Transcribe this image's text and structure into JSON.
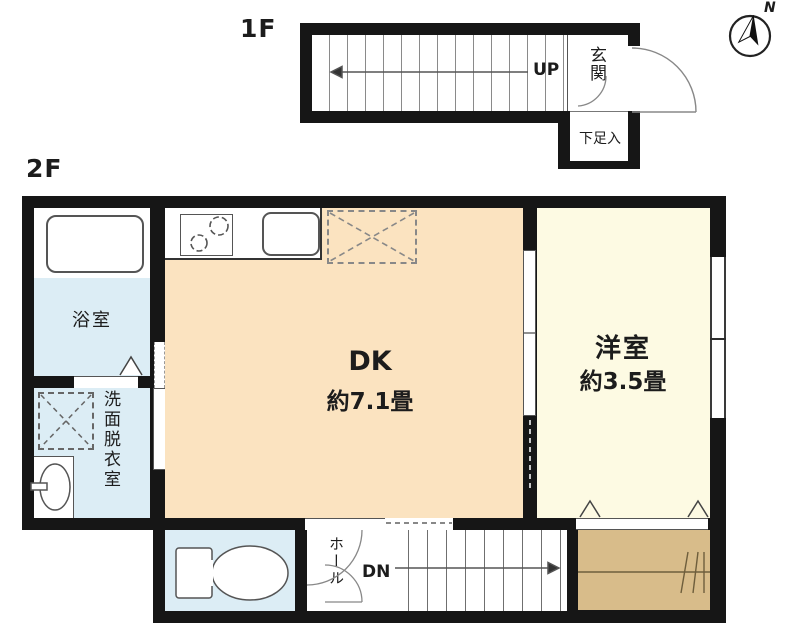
{
  "title": "間取り図",
  "compass": {
    "label": "N"
  },
  "floors": {
    "f1": {
      "label": "1F",
      "stairs_direction_label": "UP",
      "entrance_label": "玄関",
      "shoe_storage_label": "下足入"
    },
    "f2": {
      "label": "2F",
      "rooms": {
        "bathroom": {
          "label": "浴室"
        },
        "washroom": {
          "label": "洗面脱衣室"
        },
        "dk": {
          "label": "DK",
          "size": "約7.1畳"
        },
        "western_room": {
          "label": "洋室",
          "size": "約3.5畳"
        },
        "hall": {
          "label": "ホール"
        },
        "stairs": {
          "direction_label": "DN"
        }
      }
    }
  },
  "colors": {
    "wall": "#161616",
    "dk_floor": "#fbe3c0",
    "western_floor": "#fdfae3",
    "wet_area_floor": "#dcedf5",
    "balcony_floor": "#d8bc8a"
  }
}
